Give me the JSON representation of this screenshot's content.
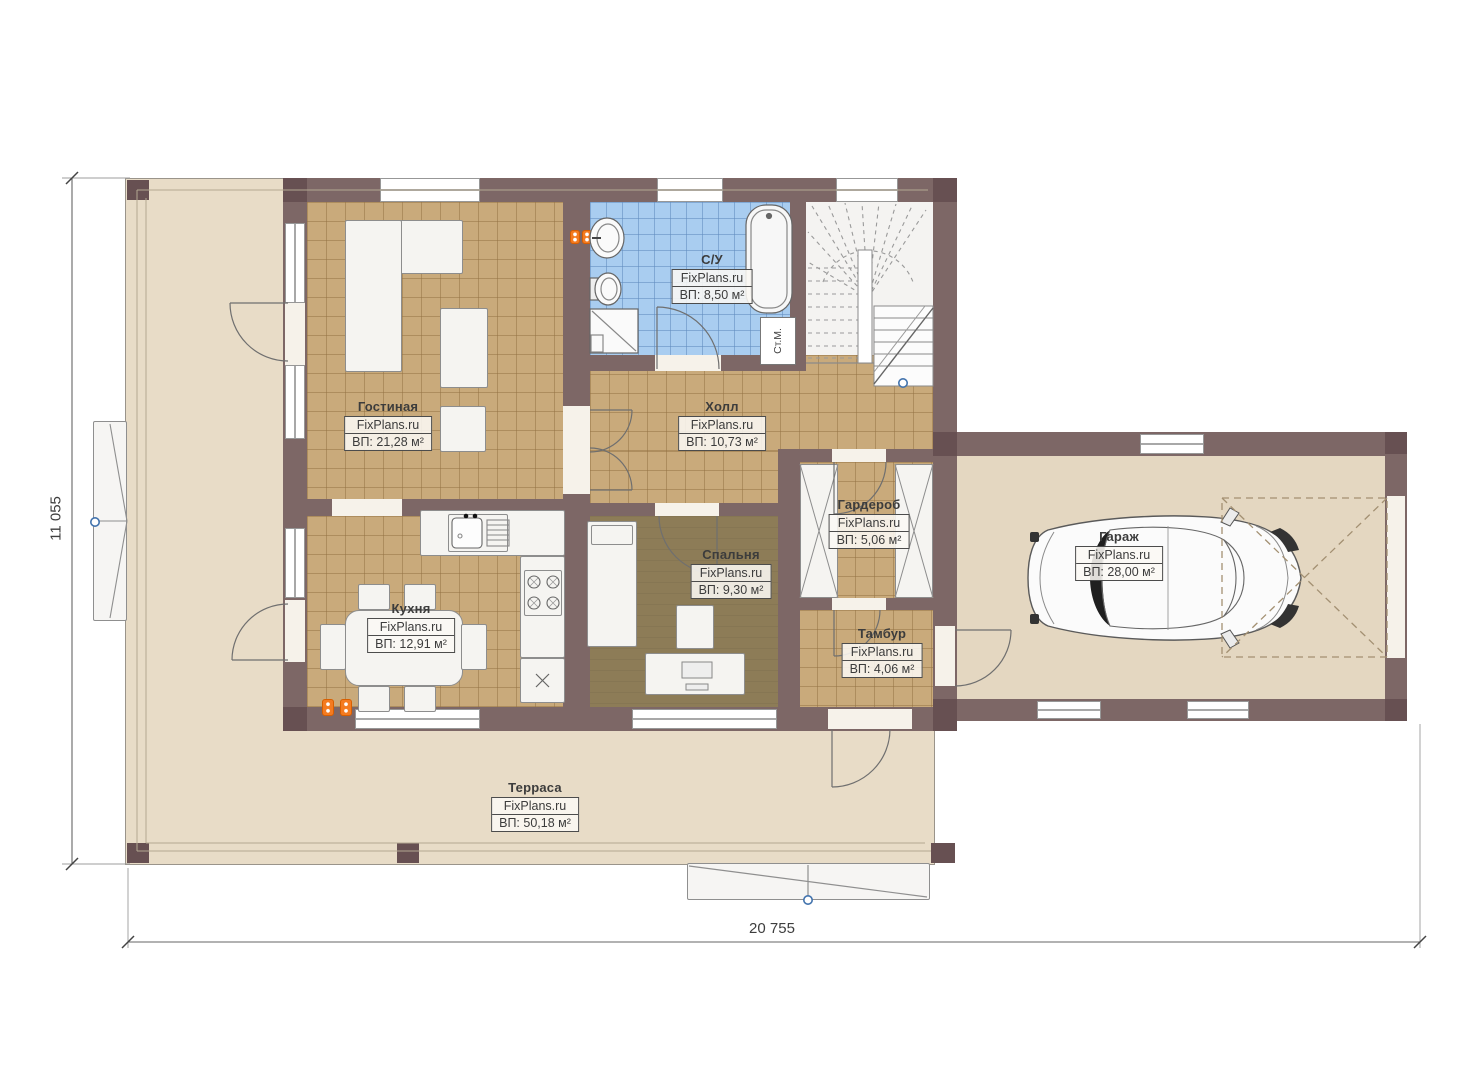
{
  "watermark_brand": "FixPlans.ru",
  "rooms": [
    {
      "name": "Гостиная",
      "brand": "FixPlans.ru",
      "area": "ВП: 21,28 м²"
    },
    {
      "name": "С/У",
      "brand": "FixPlans.ru",
      "area": "ВП: 8,50 м²"
    },
    {
      "name": "Холл",
      "brand": "FixPlans.ru",
      "area": "ВП: 10,73 м²"
    },
    {
      "name": "Гардероб",
      "brand": "FixPlans.ru",
      "area": "ВП: 5,06 м²"
    },
    {
      "name": "Кухня",
      "brand": "FixPlans.ru",
      "area": "ВП: 12,91 м²"
    },
    {
      "name": "Спальня",
      "brand": "FixPlans.ru",
      "area": "ВП: 9,30 м²"
    },
    {
      "name": "Тамбур",
      "brand": "FixPlans.ru",
      "area": "ВП: 4,06 м²"
    },
    {
      "name": "Гараж",
      "brand": "FixPlans.ru",
      "area": "ВП: 28,00 м²"
    },
    {
      "name": "Терраса",
      "brand": "FixPlans.ru",
      "area": "ВП: 50,18 м²"
    }
  ],
  "annotations": {
    "washing_machine": "Ст.М."
  },
  "dimensions": {
    "height_left": "11 055",
    "width_bottom": "20 755"
  },
  "colors": {
    "wall": "#7d6766",
    "floor_tile": "#c9aa7b",
    "bath_tile": "#a9cdf0",
    "bedroom_floor": "#8d7c57",
    "terrace_floor": "#e8dcc7",
    "garage_floor": "#e4d7c1",
    "accent_orange": "#f47b20",
    "marker_blue": "#4273ad"
  }
}
